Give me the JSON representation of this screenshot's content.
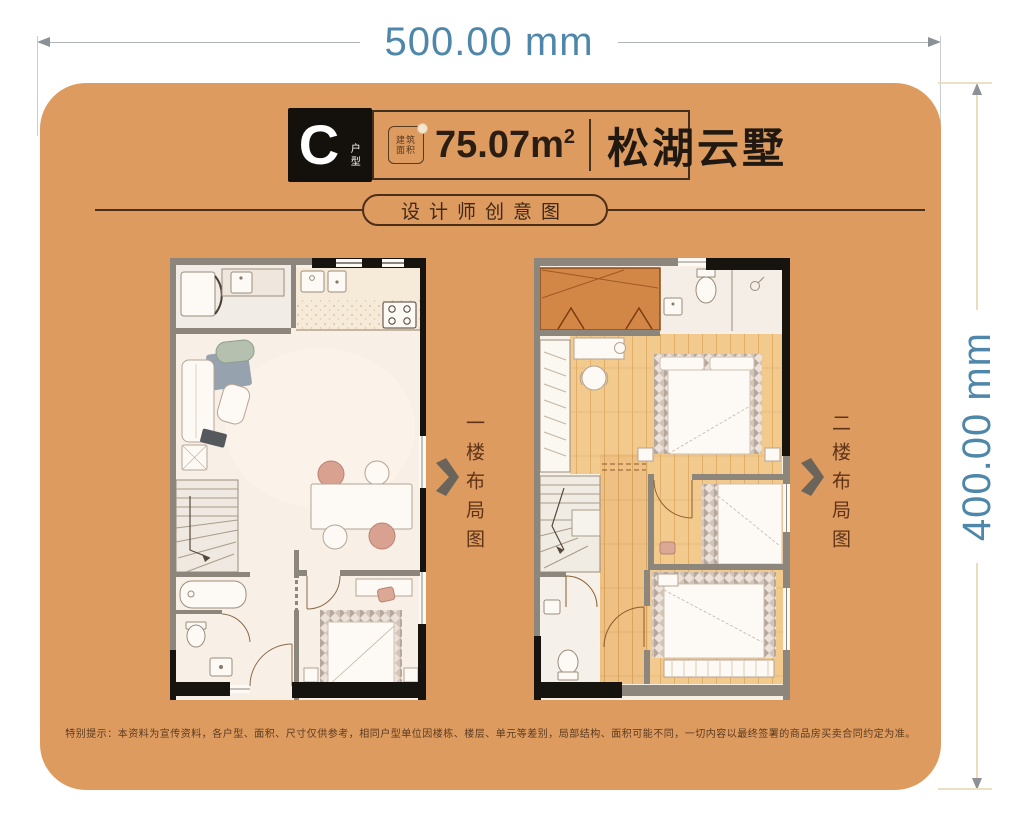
{
  "dimension_labels": {
    "width": "500.00 mm",
    "height": "400.00 mm"
  },
  "header": {
    "unit_letter": "C",
    "unit_suffix": "户型",
    "area_badge_line1": "建筑",
    "area_badge_line2": "面积",
    "area_value": "75.07m",
    "area_superscript": "2",
    "project_name": "松湖云墅"
  },
  "banner": {
    "label": "设计师创意图"
  },
  "floor_plans": {
    "first_caption": "一楼布局图",
    "second_caption": "二楼布局图"
  },
  "footer": {
    "disclaimer": "特别提示：本资料为宣传资料，各户型、面积、尺寸仅供参考，相同户型单位因楼栋、楼层、单元等差别，局部结构、面积可能不同，一切内容以最终签署的商品房买卖合同约定为准。"
  },
  "colors": {
    "card_background": "#dd9b60",
    "dimension_text": "#4e87a9",
    "header_block_background": "#14100b",
    "area_text": "#2b1d11",
    "caption_text": "#5e3317",
    "terrace": "#d28747",
    "wood_floor": "#f2ca8e"
  }
}
